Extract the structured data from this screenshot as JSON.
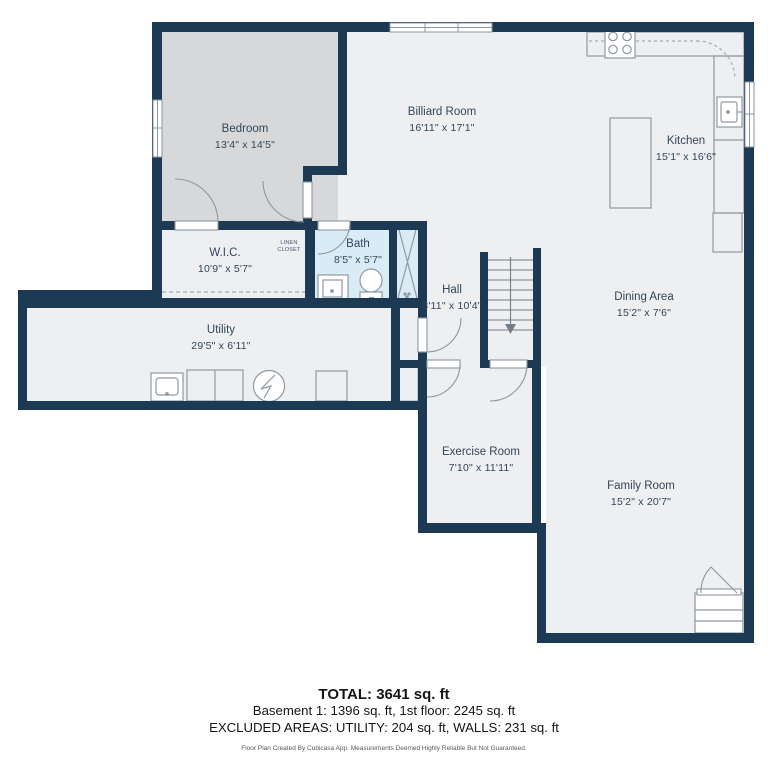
{
  "plan": {
    "rooms": [
      {
        "id": "bedroom",
        "name": "Bedroom",
        "dims": "13'4\" x 14'5\""
      },
      {
        "id": "billiard",
        "name": "Billiard Room",
        "dims": "16'11\" x 17'1\""
      },
      {
        "id": "kitchen",
        "name": "Kitchen",
        "dims": "15'1\" x 16'6\""
      },
      {
        "id": "wic",
        "name": "W.I.C.",
        "dims": "10'9\" x 5'7\""
      },
      {
        "id": "bath",
        "name": "Bath",
        "dims": "8'5\" x 5'7\""
      },
      {
        "id": "hall",
        "name": "Hall",
        "dims": "3'11\" x 10'4\""
      },
      {
        "id": "utility",
        "name": "Utility",
        "dims": "29'5\" x 6'11\""
      },
      {
        "id": "dining",
        "name": "Dining Area",
        "dims": "15'2\" x 7'6\""
      },
      {
        "id": "exercise",
        "name": "Exercise Room",
        "dims": "7'10\" x 11'11\""
      },
      {
        "id": "family",
        "name": "Family Room",
        "dims": "15'2\" x 20'7\""
      }
    ],
    "linen_closet": {
      "line1": "LINEN",
      "line2": "CLOSET"
    },
    "colors": {
      "wall": "#1c3a54",
      "floor": "#edeff0",
      "bedroom_floor": "#d7d8d9",
      "bath_floor": "#d9ecf6",
      "label_text": "#33465b",
      "fixture_line": "#8b97a0"
    }
  },
  "footer": {
    "total": "TOTAL: 3641 sq. ft",
    "line1": "Basement 1: 1396 sq. ft, 1st floor: 2245 sq. ft",
    "line2": "EXCLUDED AREAS: UTILITY: 204 sq. ft, WALLS: 231 sq. ft",
    "disclaimer": "Floor Plan Created By Cubicasa App. Measurements Deemed Highly Reliable But Not Guaranteed."
  }
}
